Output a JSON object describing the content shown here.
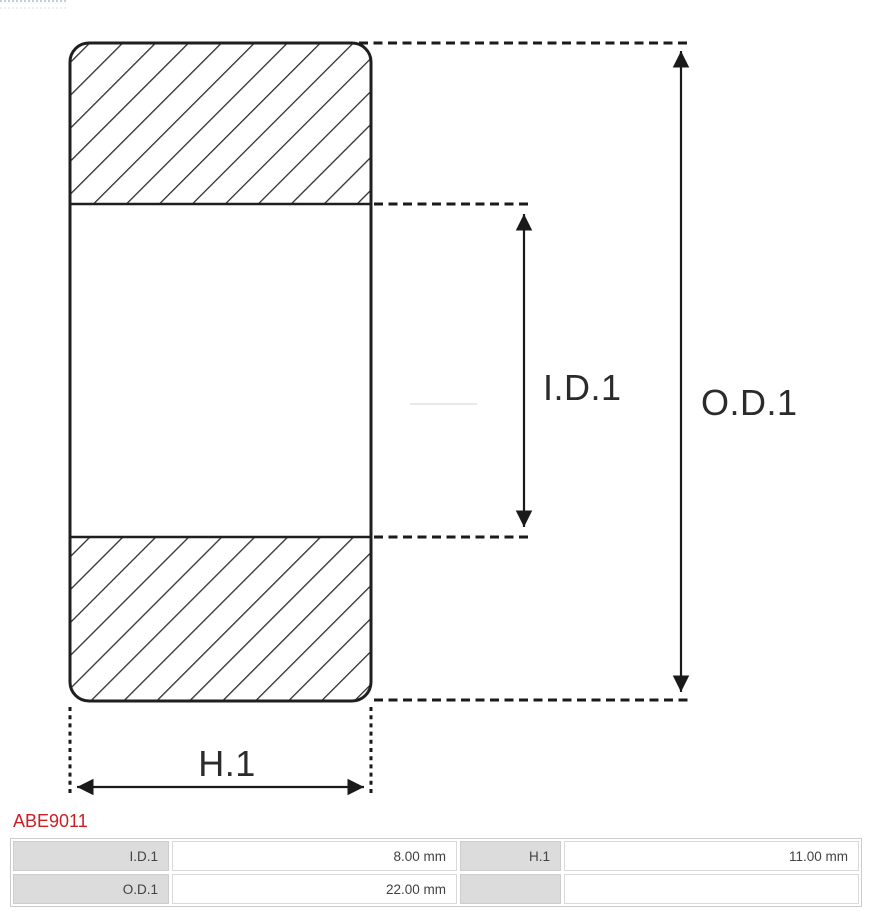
{
  "product_code": "ABE9011",
  "diagram": {
    "type": "bearing-cross-section",
    "labels": {
      "inner_diameter": "I.D.1",
      "outer_diameter": "O.D.1",
      "height": "H.1"
    }
  },
  "spec_table": {
    "rows": [
      [
        "I.D.1",
        "8.00 mm",
        "H.1",
        "11.00 mm"
      ],
      [
        "O.D.1",
        "22.00 mm",
        "",
        ""
      ]
    ]
  },
  "colors": {
    "product_code_red": "#cb2026",
    "diagram_line": "#1f1f1f",
    "table_label_bg": "#dcdcdc",
    "table_border": "#cccccc"
  }
}
